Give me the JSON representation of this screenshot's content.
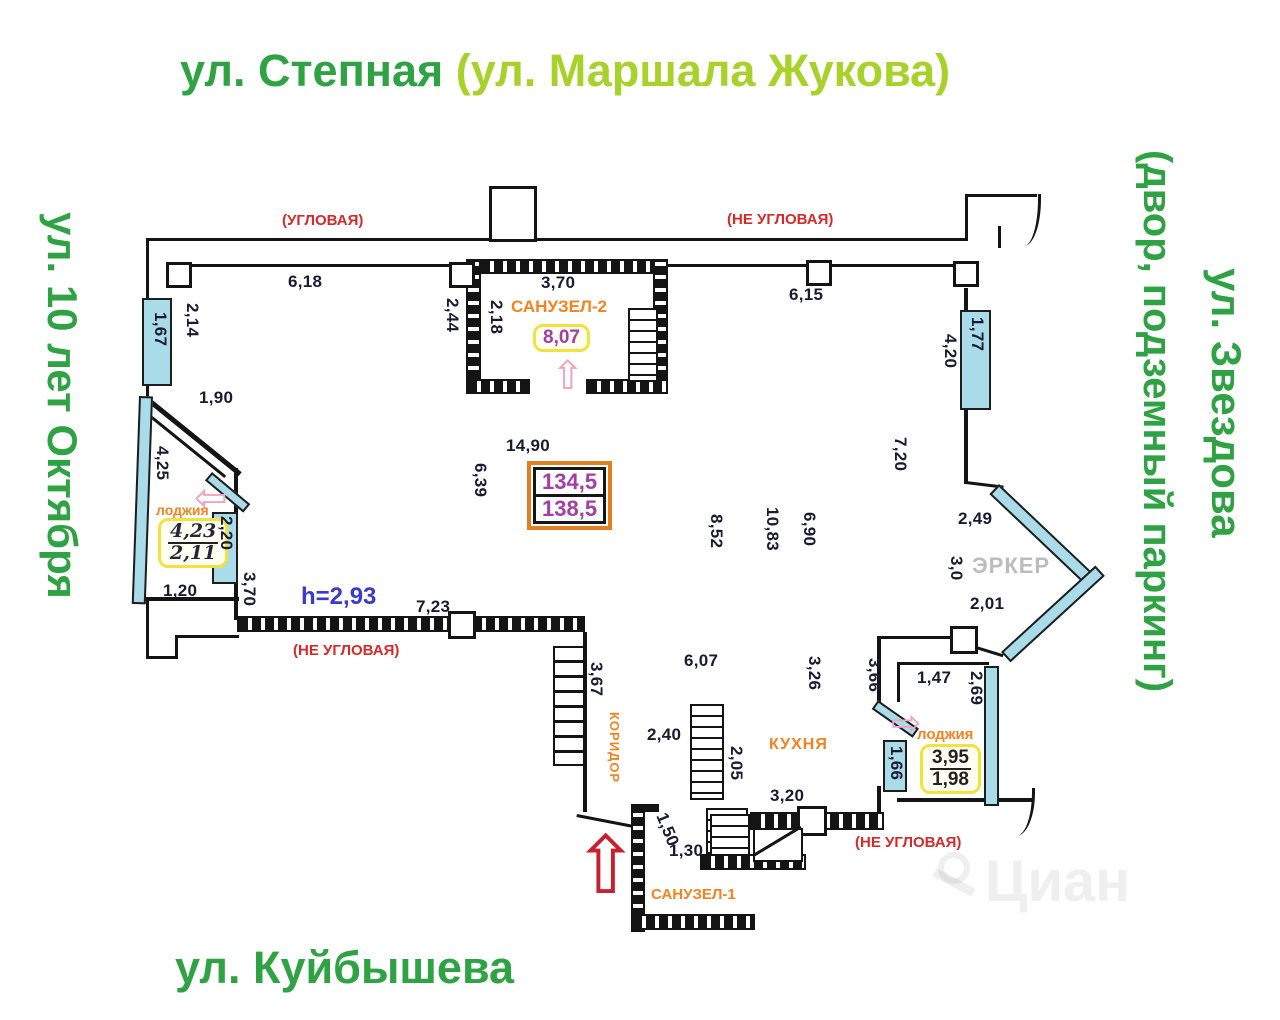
{
  "streets": {
    "top_main": "ул. Степная ",
    "top_alt": "(ул. Маршала Жукова)",
    "left": "ул. 10 лет Октября",
    "right_inner": "(двор, подземный паркинг)",
    "right_outer": "ул. Звездова",
    "bottom": "ул. Куйбышева"
  },
  "colors": {
    "street_green": "#2fa344",
    "street_light_green": "#a8d229",
    "annotation_red": "#d42a2a",
    "room_orange": "#f5821f",
    "area_purple": "#a23ea5",
    "height_blue": "#3a3acc",
    "window_blue": "#a9dbe9",
    "erker_gray": "#bcbcbc"
  },
  "plan": {
    "ceiling_height": "h=2,93",
    "total_area": {
      "upper": "134,5",
      "lower": "138,5"
    },
    "rooms": {
      "sanuzel2": {
        "label": "САНУЗЕЛ-2",
        "area": "8,07"
      },
      "sanuzel1": {
        "label": "САНУЗЕЛ-1"
      },
      "kitchen": {
        "label": "КУХНЯ"
      },
      "corridor": {
        "label": "КОРИДОР"
      },
      "loggia_left": {
        "label": "лоджия",
        "area_top": "4,23",
        "area_bottom": "2,11"
      },
      "loggia_right": {
        "label": "лоджия",
        "area_top": "3,95",
        "area_bottom": "1,98"
      },
      "erker": {
        "label": "ЭРКЕР"
      }
    },
    "corner_labels": [
      {
        "text": "(УГЛОВАЯ)",
        "x": 282,
        "y": 212
      },
      {
        "text": "(НЕ УГЛОВАЯ)",
        "x": 727,
        "y": 211
      },
      {
        "text": "(НЕ УГЛОВАЯ)",
        "x": 293,
        "y": 642
      },
      {
        "text": "(НЕ УГЛОВАЯ)",
        "x": 855,
        "y": 834
      }
    ],
    "dimensions": [
      {
        "text": "6,18",
        "x": 288,
        "y": 272,
        "rot": 0
      },
      {
        "text": "3,70",
        "x": 541,
        "y": 273,
        "rot": 0
      },
      {
        "text": "6,15",
        "x": 789,
        "y": 285,
        "rot": 0
      },
      {
        "text": "2,44",
        "x": 462,
        "y": 298,
        "rot": 90
      },
      {
        "text": "2,18",
        "x": 506,
        "y": 300,
        "rot": 90
      },
      {
        "text": "2,14",
        "x": 202,
        "y": 303,
        "rot": 90
      },
      {
        "text": "1,67",
        "x": 170,
        "y": 312,
        "rot": 90
      },
      {
        "text": "1,90",
        "x": 199,
        "y": 388,
        "rot": 0
      },
      {
        "text": "4,25",
        "x": 172,
        "y": 446,
        "rot": 90
      },
      {
        "text": "4,20",
        "x": 960,
        "y": 334,
        "rot": 90
      },
      {
        "text": "1,77",
        "x": 987,
        "y": 317,
        "rot": 90
      },
      {
        "text": "7,20",
        "x": 910,
        "y": 437,
        "rot": 90
      },
      {
        "text": "14,90",
        "x": 506,
        "y": 436,
        "rot": 0
      },
      {
        "text": "6,39",
        "x": 490,
        "y": 463,
        "rot": 90
      },
      {
        "text": "8,52",
        "x": 726,
        "y": 514,
        "rot": 90
      },
      {
        "text": "10,83",
        "x": 782,
        "y": 507,
        "rot": 90
      },
      {
        "text": "6,90",
        "x": 819,
        "y": 512,
        "rot": 90
      },
      {
        "text": "2,49",
        "x": 958,
        "y": 509,
        "rot": 0
      },
      {
        "text": "3,0",
        "x": 966,
        "y": 556,
        "rot": 90
      },
      {
        "text": "2,01",
        "x": 970,
        "y": 594,
        "rot": 0
      },
      {
        "text": "2,20",
        "x": 236,
        "y": 516,
        "rot": 90
      },
      {
        "text": "1,20",
        "x": 163,
        "y": 581,
        "rot": 0
      },
      {
        "text": "3,70",
        "x": 259,
        "y": 572,
        "rot": 90
      },
      {
        "text": "7,23",
        "x": 416,
        "y": 597,
        "rot": 0
      },
      {
        "text": "3,67",
        "x": 606,
        "y": 662,
        "rot": 90
      },
      {
        "text": "6,07",
        "x": 684,
        "y": 651,
        "rot": 0
      },
      {
        "text": "2,40",
        "x": 647,
        "y": 725,
        "rot": 0
      },
      {
        "text": "2,05",
        "x": 746,
        "y": 746,
        "rot": 90
      },
      {
        "text": "3,26",
        "x": 824,
        "y": 656,
        "rot": 90
      },
      {
        "text": "3,66",
        "x": 884,
        "y": 658,
        "rot": 90
      },
      {
        "text": "1,47",
        "x": 917,
        "y": 668,
        "rot": 0
      },
      {
        "text": "2,69",
        "x": 986,
        "y": 671,
        "rot": 90
      },
      {
        "text": "1,66",
        "x": 906,
        "y": 746,
        "rot": 90
      },
      {
        "text": "3,20",
        "x": 770,
        "y": 786,
        "rot": 0
      },
      {
        "text": "1,30",
        "x": 669,
        "y": 841,
        "rot": 0
      },
      {
        "text": "1,50",
        "x": 670,
        "y": 810,
        "rot": 68
      }
    ]
  },
  "watermark": {
    "text": "Циан"
  }
}
